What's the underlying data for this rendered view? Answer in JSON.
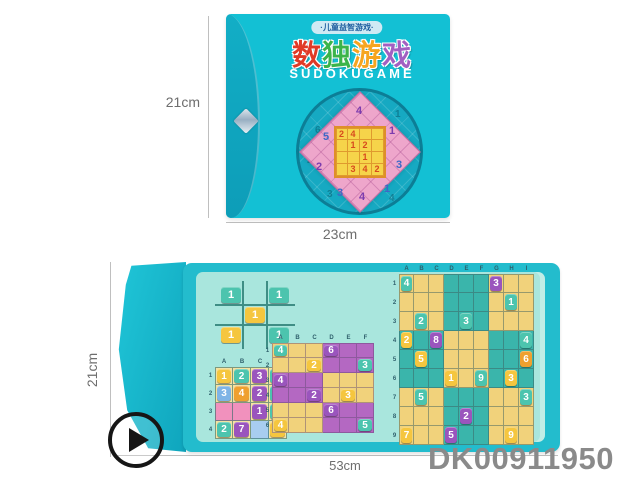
{
  "product_code": "DK00911950",
  "measurements": {
    "top_height": "21cm",
    "top_width": "23cm",
    "bottom_height": "21cm",
    "bottom_width": "53cm"
  },
  "colors": {
    "box_teal": "#13c0d4",
    "box_flap_teal": "#0d9db8",
    "page_mint": "#a9e6dd",
    "book_border": "#23bccd",
    "tiles": {
      "teal": "#4cc4ae",
      "yellow": "#f5c63f",
      "purple": "#9a55bd",
      "orange": "#efa02f",
      "blue": "#7fb4e6"
    }
  },
  "cover": {
    "banner": "·儿童益智游戏·",
    "title_chars": [
      {
        "ch": "数",
        "color": "#e03a26"
      },
      {
        "ch": "独",
        "color": "#3bb44a"
      },
      {
        "ch": "游",
        "color": "#f6a51f"
      },
      {
        "ch": "戏",
        "color": "#a25fc2"
      }
    ],
    "subtitle": "SUDOKUGAME",
    "circle_numbers": [
      "6",
      "1",
      "2",
      "5",
      "3",
      "4"
    ],
    "diamond_numbers": [
      "4",
      "5",
      "1",
      "3",
      "2",
      "3",
      "4",
      "1"
    ],
    "inner_grid": {
      "rows": 4,
      "cols": 4,
      "default_bg": "#f6d44a",
      "numbers": [
        [
          "2",
          "4",
          "",
          ""
        ],
        [
          "",
          "1",
          "2",
          ""
        ],
        [
          "",
          "",
          "1",
          ""
        ],
        [
          "",
          "3",
          "4",
          "2"
        ]
      ]
    }
  },
  "open_view": {
    "ttt": {
      "rows": 3,
      "cols": 3,
      "tiles": [
        {
          "r": 1,
          "c": 1,
          "n": "1",
          "t": "teal"
        },
        {
          "r": 1,
          "c": 3,
          "n": "1",
          "t": "teal"
        },
        {
          "r": 2,
          "c": 2,
          "n": "1",
          "t": "yellow"
        },
        {
          "r": 3,
          "c": 1,
          "n": "1",
          "t": "yellow"
        },
        {
          "r": 3,
          "c": 3,
          "n": "1",
          "t": "teal"
        }
      ]
    },
    "grid4": {
      "rows": 4,
      "cols": 4,
      "col_labels": [
        "A",
        "B",
        "C",
        "D"
      ],
      "row_labels": [
        "1",
        "2",
        "3",
        "4"
      ],
      "default_bg": "#f4e2a2",
      "cell_bg": [
        {
          "r": 3,
          "c": 1,
          "bg": "#f191bd"
        },
        {
          "r": 3,
          "c": 2,
          "bg": "#f191bd"
        },
        {
          "r": 4,
          "c": 3,
          "bg": "#a8cdf0"
        }
      ],
      "tiles": [
        {
          "r": 1,
          "c": 1,
          "n": "1",
          "t": "yellow"
        },
        {
          "r": 1,
          "c": 2,
          "n": "2",
          "t": "teal"
        },
        {
          "r": 1,
          "c": 3,
          "n": "3",
          "t": "purple"
        },
        {
          "r": 1,
          "c": 4,
          "n": "1",
          "t": "teal"
        },
        {
          "r": 2,
          "c": 1,
          "n": "3",
          "t": "blue"
        },
        {
          "r": 2,
          "c": 2,
          "n": "4",
          "t": "orange"
        },
        {
          "r": 2,
          "c": 3,
          "n": "2",
          "t": "purple"
        },
        {
          "r": 2,
          "c": 4,
          "n": "1",
          "t": "teal"
        },
        {
          "r": 3,
          "c": 3,
          "n": "1",
          "t": "purple"
        },
        {
          "r": 3,
          "c": 4,
          "n": "3",
          "t": "teal"
        },
        {
          "r": 4,
          "c": 1,
          "n": "2",
          "t": "teal"
        },
        {
          "r": 4,
          "c": 2,
          "n": "7",
          "t": "purple"
        },
        {
          "r": 4,
          "c": 4,
          "n": "4",
          "t": "yellow"
        }
      ]
    },
    "grid6": {
      "rows": 6,
      "cols": 6,
      "col_labels": [
        "A",
        "B",
        "C",
        "D",
        "E",
        "F"
      ],
      "row_labels": [
        "1",
        "2",
        "3",
        "4",
        "5",
        "6"
      ],
      "block": [
        2,
        3
      ],
      "block_colors": [
        "#f1d27b",
        "#b468c2"
      ],
      "tiles": [
        {
          "r": 1,
          "c": 1,
          "n": "4",
          "t": "teal"
        },
        {
          "r": 1,
          "c": 4,
          "n": "6",
          "t": "purple"
        },
        {
          "r": 2,
          "c": 3,
          "n": "2",
          "t": "yellow"
        },
        {
          "r": 2,
          "c": 6,
          "n": "3",
          "t": "teal"
        },
        {
          "r": 3,
          "c": 1,
          "n": "4",
          "t": "purple"
        },
        {
          "r": 4,
          "c": 3,
          "n": "2",
          "t": "purple"
        },
        {
          "r": 4,
          "c": 5,
          "n": "3",
          "t": "yellow"
        },
        {
          "r": 5,
          "c": 4,
          "n": "6",
          "t": "purple"
        },
        {
          "r": 6,
          "c": 1,
          "n": "4",
          "t": "yellow"
        },
        {
          "r": 6,
          "c": 6,
          "n": "5",
          "t": "teal"
        }
      ]
    },
    "grid9": {
      "rows": 9,
      "cols": 9,
      "col_labels": [
        "A",
        "B",
        "C",
        "D",
        "E",
        "F",
        "G",
        "H",
        "I"
      ],
      "row_labels": [
        "1",
        "2",
        "3",
        "4",
        "5",
        "6",
        "7",
        "8",
        "9"
      ],
      "block": [
        3,
        3
      ],
      "block_colors": [
        "#f1d27b",
        "#3ab5ab"
      ],
      "tiles": [
        {
          "r": 1,
          "c": 1,
          "n": "4",
          "t": "teal"
        },
        {
          "r": 1,
          "c": 7,
          "n": "3",
          "t": "purple"
        },
        {
          "r": 2,
          "c": 8,
          "n": "1",
          "t": "teal"
        },
        {
          "r": 3,
          "c": 2,
          "n": "2",
          "t": "teal"
        },
        {
          "r": 3,
          "c": 5,
          "n": "3",
          "t": "teal"
        },
        {
          "r": 4,
          "c": 1,
          "n": "2",
          "t": "yellow"
        },
        {
          "r": 4,
          "c": 3,
          "n": "8",
          "t": "purple"
        },
        {
          "r": 4,
          "c": 9,
          "n": "4",
          "t": "teal"
        },
        {
          "r": 5,
          "c": 2,
          "n": "5",
          "t": "yellow"
        },
        {
          "r": 5,
          "c": 9,
          "n": "6",
          "t": "orange"
        },
        {
          "r": 6,
          "c": 4,
          "n": "1",
          "t": "yellow"
        },
        {
          "r": 6,
          "c": 6,
          "n": "9",
          "t": "teal"
        },
        {
          "r": 6,
          "c": 8,
          "n": "3",
          "t": "yellow"
        },
        {
          "r": 7,
          "c": 2,
          "n": "5",
          "t": "teal"
        },
        {
          "r": 7,
          "c": 9,
          "n": "3",
          "t": "teal"
        },
        {
          "r": 8,
          "c": 5,
          "n": "2",
          "t": "purple"
        },
        {
          "r": 9,
          "c": 1,
          "n": "7",
          "t": "yellow"
        },
        {
          "r": 9,
          "c": 4,
          "n": "5",
          "t": "purple"
        },
        {
          "r": 9,
          "c": 8,
          "n": "9",
          "t": "yellow"
        }
      ]
    }
  }
}
